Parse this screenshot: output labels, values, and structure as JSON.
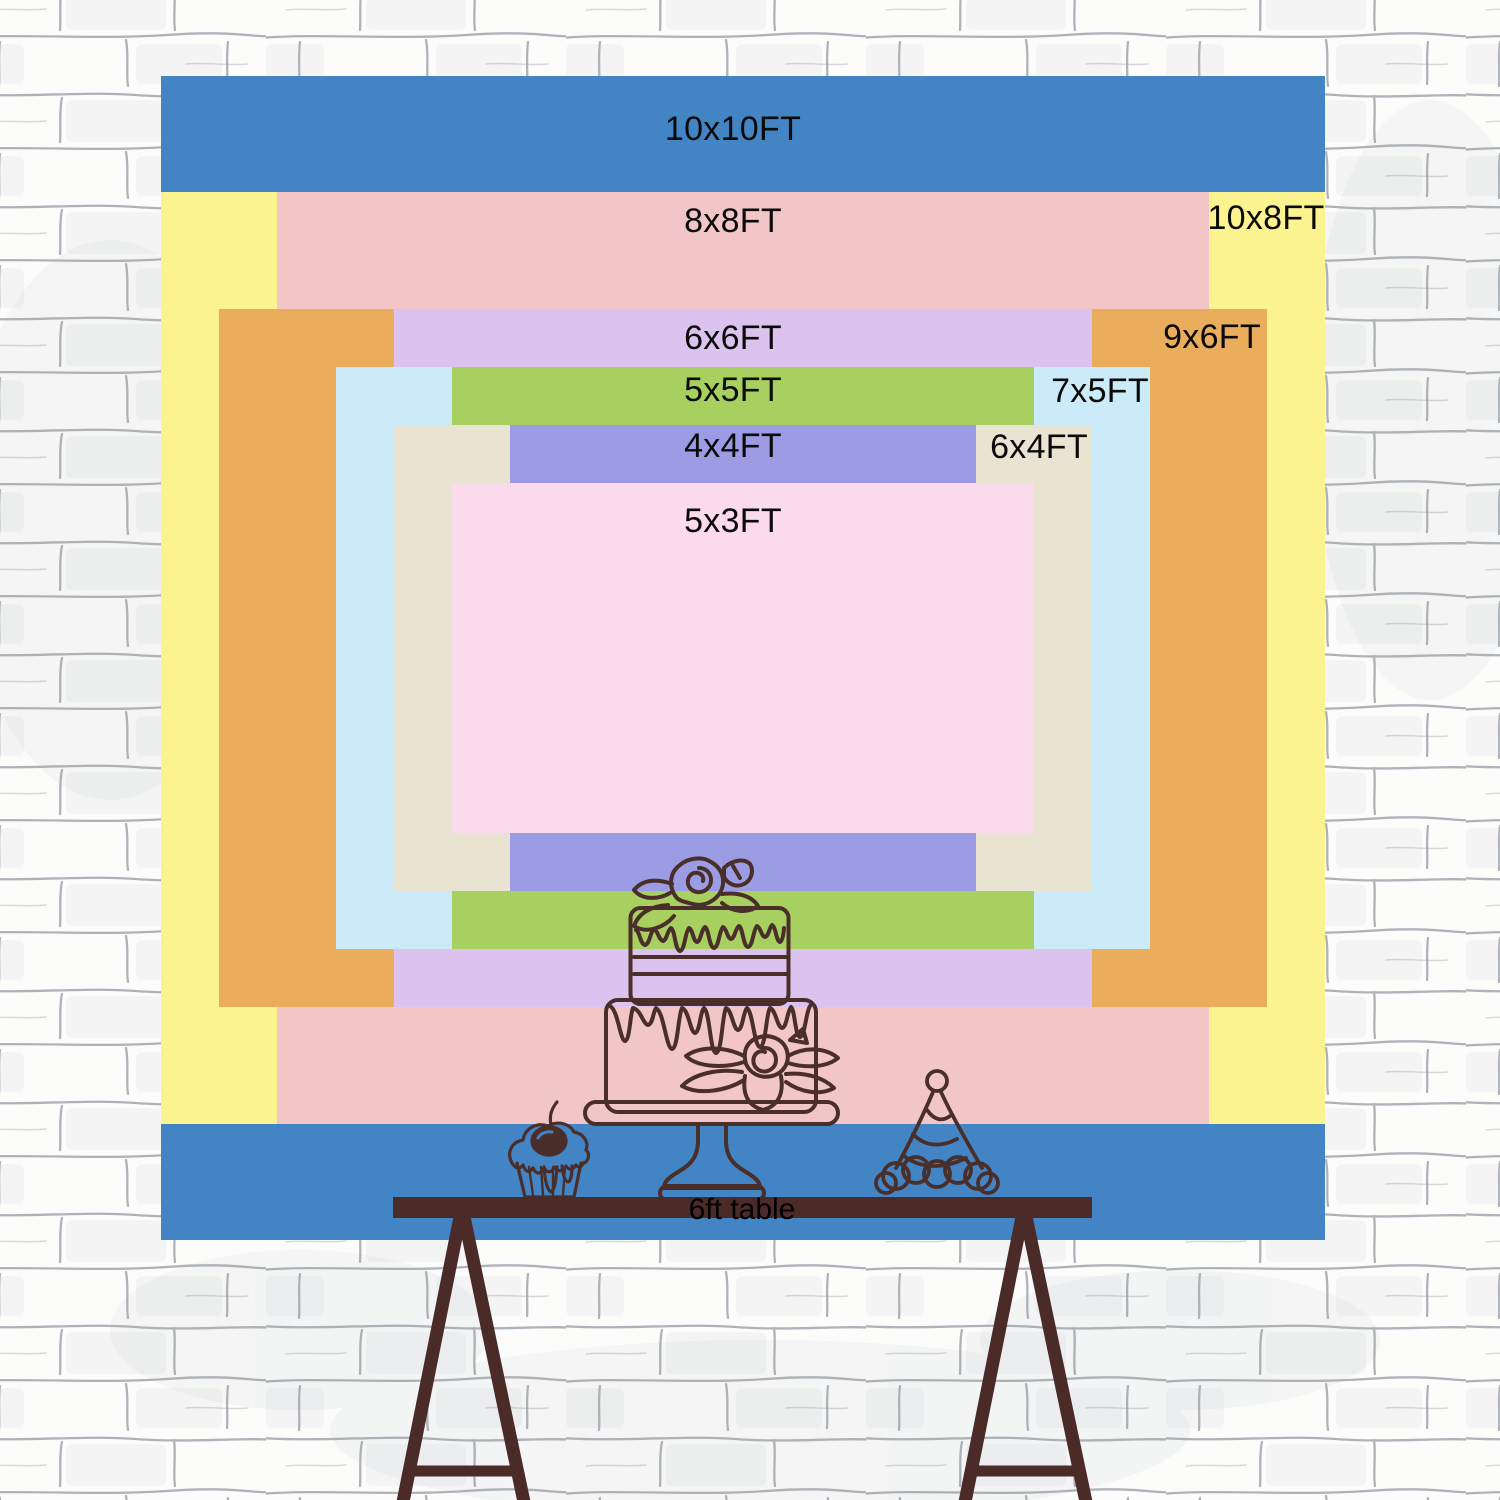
{
  "meta": {
    "description": "Backdrop size chart with nested rectangles on a white brick wall, table with cake in front",
    "unit": "FT"
  },
  "wall": {
    "background": "#fcfcfb",
    "mortar_line_color": "#6f7683",
    "smudge_color": "#9aa1ab"
  },
  "backdrop": {
    "label_color": "#0b0b0b",
    "sizes": [
      {
        "id": "10x10",
        "label": "10x10FT",
        "width_ft": 10,
        "height_ft": 10,
        "color": "#4384C5",
        "label_x": 733,
        "label_y": 129
      },
      {
        "id": "10x8",
        "label": "10x8FT",
        "width_ft": 10,
        "height_ft": 8,
        "color": "#FBF290",
        "label_x": 1266,
        "label_y": 218
      },
      {
        "id": "8x8",
        "label": "8x8FT",
        "width_ft": 8,
        "height_ft": 8,
        "color": "#F2C5C7",
        "label_x": 733,
        "label_y": 221
      },
      {
        "id": "9x6",
        "label": "9x6FT",
        "width_ft": 9,
        "height_ft": 6,
        "color": "#EAAD5C",
        "label_x": 1212,
        "label_y": 337
      },
      {
        "id": "6x6",
        "label": "6x6FT",
        "width_ft": 6,
        "height_ft": 6,
        "color": "#DCC3EF",
        "label_x": 733,
        "label_y": 338
      },
      {
        "id": "7x5",
        "label": "7x5FT",
        "width_ft": 7,
        "height_ft": 5,
        "color": "#CBEBF8",
        "label_x": 1100,
        "label_y": 391
      },
      {
        "id": "5x5",
        "label": "5x5FT",
        "width_ft": 5,
        "height_ft": 5,
        "color": "#A7D060",
        "label_x": 733,
        "label_y": 390
      },
      {
        "id": "6x4",
        "label": "6x4FT",
        "width_ft": 6,
        "height_ft": 4,
        "color": "#E9E3D2",
        "label_x": 1039,
        "label_y": 447
      },
      {
        "id": "4x4",
        "label": "4x4FT",
        "width_ft": 4,
        "height_ft": 4,
        "color": "#9B9CE4",
        "label_x": 733,
        "label_y": 446
      },
      {
        "id": "5x3",
        "label": "5x3FT",
        "width_ft": 5,
        "height_ft": 3,
        "color": "#FBDAEC",
        "label_x": 733,
        "label_y": 521
      }
    ]
  },
  "table": {
    "label": "6ft table",
    "label_color": "#000000",
    "surface_color": "#4A2B28",
    "frame_color": "#4A2B28"
  },
  "illustrations": {
    "stroke_color": "#4A2E2A",
    "items": [
      "birthday-cake",
      "cupcake",
      "party-hat"
    ]
  }
}
